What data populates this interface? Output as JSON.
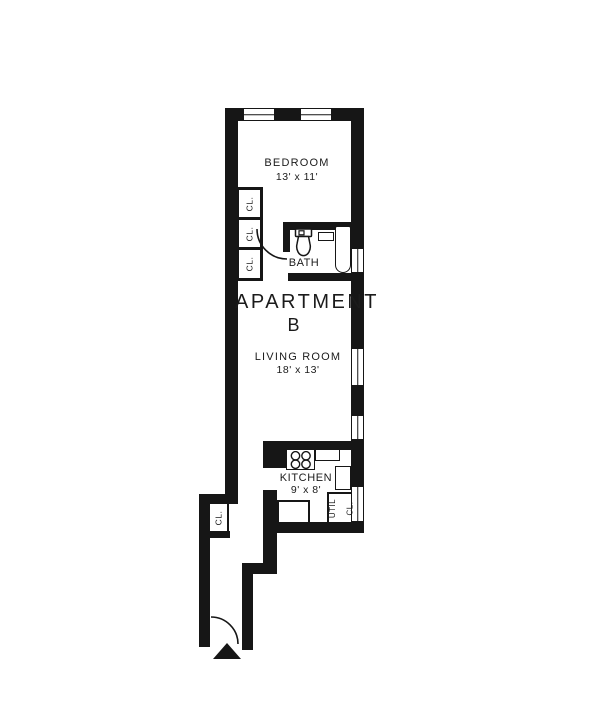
{
  "title": {
    "line1": "APARTMENT",
    "line2": "B"
  },
  "rooms": {
    "bedroom": {
      "label": "BEDROOM",
      "dims": "13' x 11'"
    },
    "bath": {
      "label": "BATH"
    },
    "living_room": {
      "label": "LIVING ROOM",
      "dims": "18' x 13'"
    },
    "kitchen": {
      "label": "KITCHEN",
      "dims": "9' x 8'"
    }
  },
  "closets": {
    "bedroom": [
      {
        "label": "CL."
      },
      {
        "label": "CL."
      },
      {
        "label": "CL."
      }
    ],
    "hall": {
      "label": "CL."
    },
    "utility": {
      "line1": "UTIL",
      "line2": "CL."
    }
  },
  "icons": {
    "toilet": "toilet-icon",
    "sink": "sink-icon",
    "bathtub": "bathtub-icon",
    "stove": "stove-burners-icon",
    "entry_arrow": "entry-arrow-icon",
    "door_swing": "door-swing-arc",
    "window": "window-symbol"
  },
  "colors": {
    "wall": "#161616",
    "background": "#ffffff",
    "text": "#1b1b1b"
  }
}
